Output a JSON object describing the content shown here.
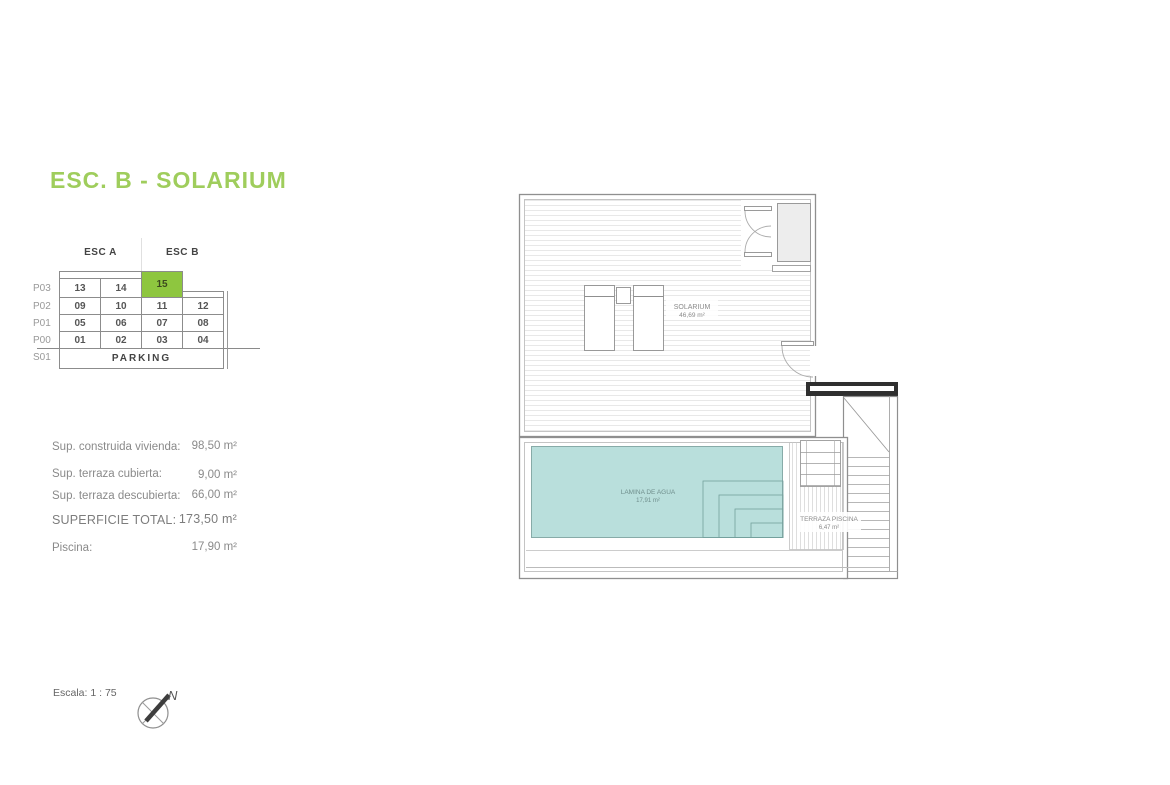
{
  "page": {
    "title": "ESC. B - SOLARIUM",
    "title_color": "#9fcd5c",
    "accent_color": "#8ec63f"
  },
  "key_table": {
    "headers": {
      "esc_a": "ESC A",
      "esc_b": "ESC B"
    },
    "row_labels": [
      "P03",
      "P02",
      "P01",
      "P00",
      "S01"
    ],
    "p03": [
      "13",
      "14",
      "15"
    ],
    "p02": [
      "09",
      "10",
      "11",
      "12"
    ],
    "p01": [
      "05",
      "06",
      "07",
      "08"
    ],
    "p00": [
      "01",
      "02",
      "03",
      "04"
    ],
    "s01": "PARKING",
    "highlighted_unit": "15"
  },
  "areas": {
    "construida": {
      "label": "Sup. construida vivienda:",
      "value": "98,50 m²"
    },
    "terraza_cubierta": {
      "label": "Sup. terraza cubierta:",
      "value": "9,00 m²"
    },
    "terraza_descubierta": {
      "label": "Sup. terraza descubierta:",
      "value": "66,00 m²"
    },
    "total": {
      "label": "SUPERFICIE TOTAL:",
      "value": "173,50 m²"
    },
    "piscina": {
      "label": "Piscina:",
      "value": "17,90 m²"
    }
  },
  "plan": {
    "solarium_label": "SOLARIUM",
    "solarium_area": "46,69 m²",
    "pool_label": "LAMINA DE AGUA",
    "pool_area": "17,91 m²",
    "terrace_label": "TERRAZA PISCINA",
    "terrace_area": "6,47 m²",
    "pool_color": "#b9dfdc"
  },
  "footer": {
    "scale_label": "Escala: 1 : 75",
    "north_label": "N"
  }
}
